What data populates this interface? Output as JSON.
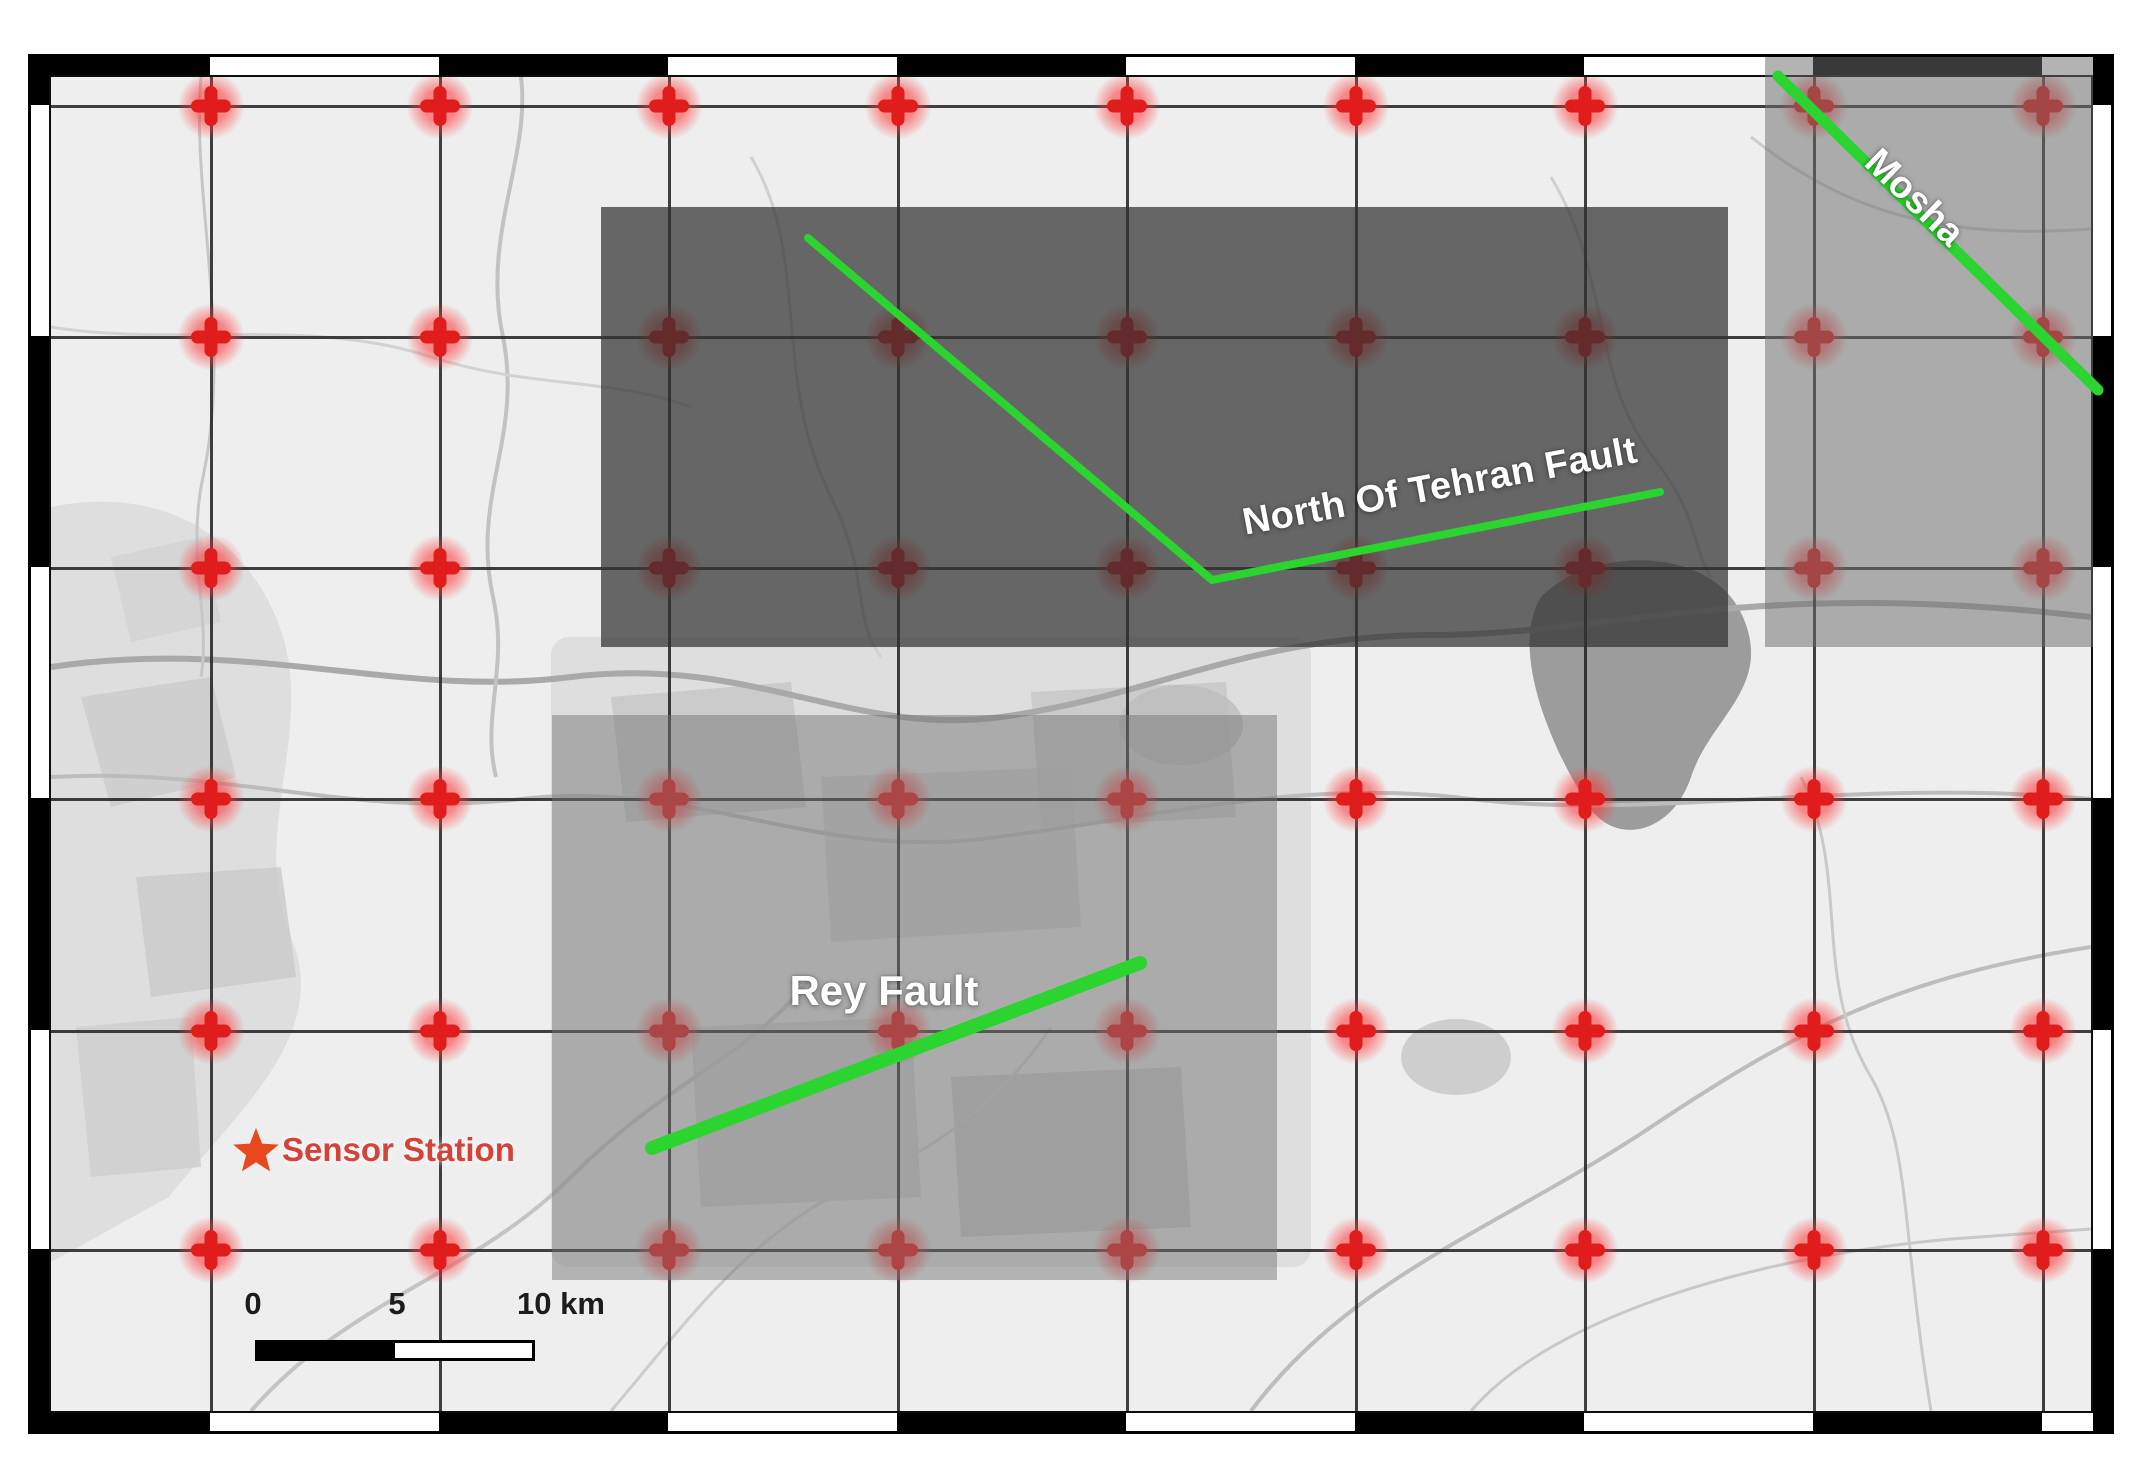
{
  "map_figure": {
    "title": "Tehran fault map with sensor grid",
    "faults": {
      "north_tehran": {
        "label": "North Of Tehran Fault",
        "points": [
          [
            808,
            238
          ],
          [
            1212,
            580
          ],
          [
            1660,
            492
          ]
        ],
        "width": 8
      },
      "mosha": {
        "label": "Mosha",
        "points": [
          [
            1778,
            76
          ],
          [
            2098,
            390
          ]
        ],
        "width": 11
      },
      "rey": {
        "label": "Rey Fault",
        "points": [
          [
            652,
            1148
          ],
          [
            1140,
            963
          ]
        ],
        "width": 14
      }
    },
    "sensor_station": {
      "label": "Sensor Station",
      "x": 256,
      "y": 1150
    },
    "scale_bar": {
      "tick_labels": [
        "0",
        "5",
        "10 km"
      ],
      "tick_x": [
        253,
        397,
        561
      ]
    },
    "grid": {
      "columns_px": [
        210,
        439,
        668,
        897,
        1126,
        1355,
        1584,
        1813,
        2042
      ],
      "rows_px": [
        105,
        336,
        567,
        798,
        1030,
        1249
      ]
    },
    "overlays": [
      {
        "name": "north-tehran-region",
        "x": 601,
        "y": 207,
        "w": 1127,
        "h": 440,
        "color": "rgba(50,50,50,0.72)"
      },
      {
        "name": "mosha-region",
        "x": 1765,
        "y": 57,
        "w": 328,
        "h": 590,
        "color": "rgba(110,110,110,0.52)"
      },
      {
        "name": "tehran-city-region",
        "x": 552,
        "y": 715,
        "w": 725,
        "h": 565,
        "color": "rgba(115,115,115,0.48)"
      }
    ],
    "colors": {
      "fault_line": "#2bd42f",
      "marker_red": "#e01c1c",
      "sensor_text": "#d4423a",
      "star_orange": "#e8481e",
      "map_background": "#eeeeee"
    }
  }
}
